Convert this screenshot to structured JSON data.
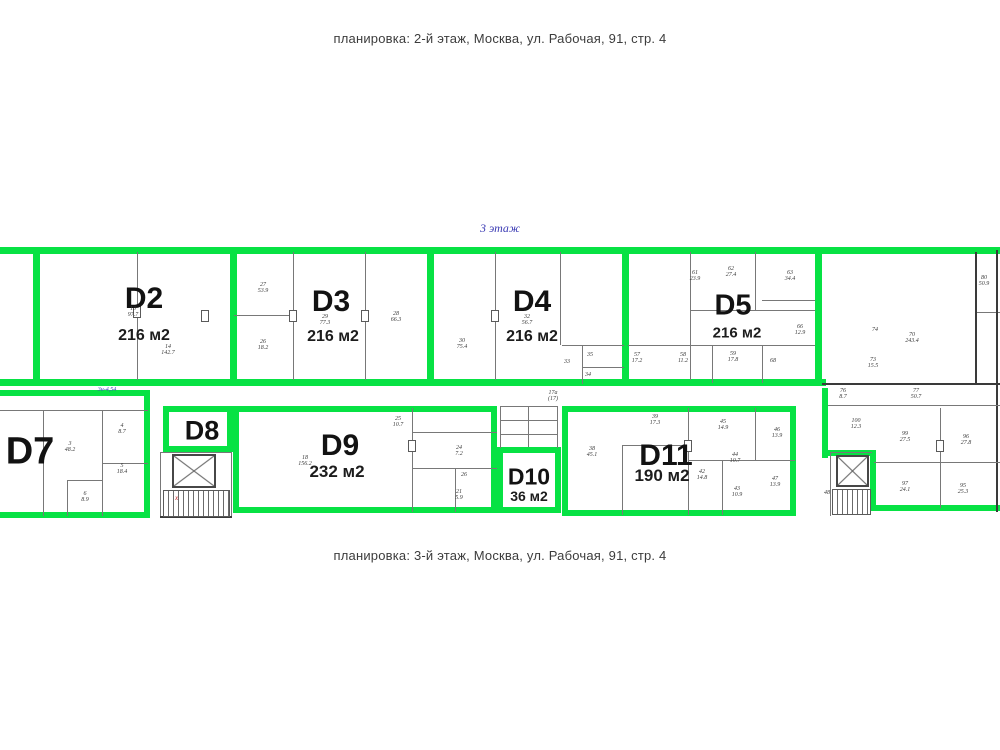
{
  "page": {
    "caption_top": "планировка: 2-й этаж, Москва, ул. Рабочая, 91, стр. 4",
    "caption_bottom": "планировка: 3-й этаж, Москва, ул. Рабочая, 91, стр. 4",
    "floor_label": "3 этаж"
  },
  "colors": {
    "highlight": "#07e244",
    "wall": "#787878",
    "note_blue": "#4646c0"
  },
  "units": {
    "d2": {
      "name": "D2",
      "area": "216 м2"
    },
    "d3": {
      "name": "D3",
      "area": "216 м2"
    },
    "d4": {
      "name": "D4",
      "area": "216 м2"
    },
    "d5": {
      "name": "D5",
      "area": "216 м2"
    },
    "d7": {
      "name": "D7"
    },
    "d8": {
      "name": "D8"
    },
    "d9": {
      "name": "D9",
      "area": "232 м2"
    },
    "d10": {
      "name": "D10",
      "area": "36 м2"
    },
    "d11": {
      "name": "D11",
      "area": "190 м2"
    }
  },
  "annotations": {
    "dim_note": "3н-4,54",
    "wc_note": "17а\n(17)",
    "stair_mark": "х"
  },
  "rooms": {
    "r13": "13\n97.7",
    "r14": "14\n142.7",
    "r27": "27\n53.9",
    "r26": "26\n18.2",
    "r29": "29\n77.3",
    "r28": "28\n66.3",
    "r30": "30\n75.4",
    "r32": "32\n56.7",
    "r33": "33",
    "r35": "35",
    "r34": "34",
    "r61": "61\n23.9",
    "r62": "62\n27.4",
    "r63": "63\n34.4",
    "r66": "66\n12.9",
    "r57": "57\n17.2",
    "r58": "58\n11.2",
    "r59": "59\n17.8",
    "r68": "68",
    "r70": "70\n243.4",
    "r80": "80\n50.9",
    "r74": "74",
    "r73": "73\n15.5",
    "r76": "76\n8.7",
    "r77": "77\n50.7",
    "r100": "100\n12.3",
    "r3": "3\n48.2",
    "r4": "4\n8.7",
    "r5": "5\n18.4",
    "r6": "6\n8.9",
    "r18": "18\n156.2",
    "r25": "25\n10.7",
    "r24": "24\n7.2",
    "r26b": "26",
    "r21": "21\n5.9",
    "r38": "38\n45.1",
    "r39": "39\n17.3",
    "r45": "45\n14.9",
    "r46": "46\n13.9",
    "r44": "44\n10.7",
    "r42": "42\n14.8",
    "r43": "43\n10.9",
    "r47": "47\n13.9",
    "r48": "48",
    "r99": "99\n27.5",
    "r96": "96\n27.8",
    "r97": "97\n24.1",
    "r95": "95\n25.3"
  }
}
